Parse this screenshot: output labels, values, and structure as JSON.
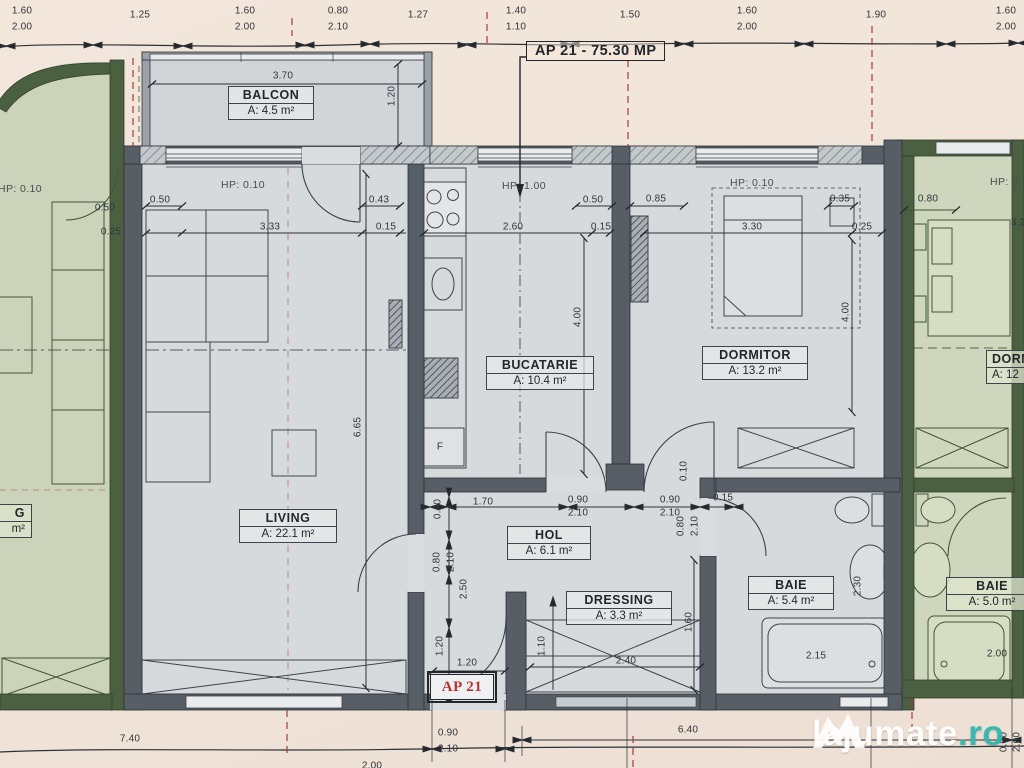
{
  "title": "AP 21 - 75.30 MP",
  "apartment_tag": "AP 21",
  "watermark": {
    "brand": "lajumate",
    "tld": ".ro"
  },
  "rooms": {
    "balcon": {
      "name": "BALCON",
      "area": "A: 4.5 m²"
    },
    "bucatarie": {
      "name": "BUCATARIE",
      "area": "A: 10.4 m²"
    },
    "dormitor": {
      "name": "DORMITOR",
      "area": "A: 13.2 m²"
    },
    "living": {
      "name": "LIVING",
      "area": "A: 22.1 m²"
    },
    "hol": {
      "name": "HOL",
      "area": "A: 6.1 m²"
    },
    "dressing": {
      "name": "DRESSING",
      "area": "A: 3.3 m²"
    },
    "baie": {
      "name": "BAIE",
      "area": "A: 5.4 m²"
    }
  },
  "adjacent": {
    "right_dormitor": {
      "name": "DORM",
      "area": "A: 12"
    },
    "right_baie": {
      "name": "BAIE",
      "area": "A: 5.0 m²"
    },
    "left_room": {
      "name": "G",
      "area": "m²"
    }
  },
  "colors": {
    "accent_red": "#a93b33",
    "watermark_teal": "#31b5ac",
    "wall_gray": "#575e66",
    "wall_green": "#4a6040",
    "floor_gray": "#d7dadc",
    "floor_green": "#cbd4ba",
    "paper": "#f1e5da"
  },
  "dims": [
    {
      "t": "1.60",
      "x": 22,
      "y": 11
    },
    {
      "t": "2.00",
      "x": 22,
      "y": 27
    },
    {
      "t": "1.25",
      "x": 140,
      "y": 15
    },
    {
      "t": "1.60",
      "x": 245,
      "y": 11
    },
    {
      "t": "2.00",
      "x": 245,
      "y": 27
    },
    {
      "t": "0.80",
      "x": 338,
      "y": 11
    },
    {
      "t": "2.10",
      "x": 338,
      "y": 27
    },
    {
      "t": "1.27",
      "x": 418,
      "y": 15
    },
    {
      "t": "1.40",
      "x": 516,
      "y": 11
    },
    {
      "t": "1.10",
      "x": 516,
      "y": 27
    },
    {
      "t": "1.50",
      "x": 630,
      "y": 15
    },
    {
      "t": "1.60",
      "x": 747,
      "y": 11
    },
    {
      "t": "2.00",
      "x": 747,
      "y": 27
    },
    {
      "t": "1.90",
      "x": 876,
      "y": 15
    },
    {
      "t": "1.60",
      "x": 1006,
      "y": 11
    },
    {
      "t": "2.00",
      "x": 1006,
      "y": 27
    },
    {
      "t": "3.70",
      "x": 283,
      "y": 76
    },
    {
      "t": "1.20",
      "x": 392,
      "y": 96,
      "r": 1
    },
    {
      "t": "HP: 0.10",
      "x": 243,
      "y": 185,
      "hp": 1
    },
    {
      "t": "HP: 1.00",
      "x": 524,
      "y": 186,
      "hp": 1
    },
    {
      "t": "HP: 0.10",
      "x": 752,
      "y": 183,
      "hp": 1
    },
    {
      "t": "HP: 0.10",
      "x": 20,
      "y": 189,
      "hp": 1
    },
    {
      "t": "HP: 0.10",
      "x": 1012,
      "y": 182,
      "hp": 1
    },
    {
      "t": "0.50",
      "x": 105,
      "y": 208
    },
    {
      "t": "0.25",
      "x": 111,
      "y": 232
    },
    {
      "t": "0.50",
      "x": 160,
      "y": 200
    },
    {
      "t": "3.33",
      "x": 270,
      "y": 227
    },
    {
      "t": "0.43",
      "x": 379,
      "y": 200
    },
    {
      "t": "0.15",
      "x": 386,
      "y": 227
    },
    {
      "t": "2.60",
      "x": 513,
      "y": 227
    },
    {
      "t": "0.15",
      "x": 601,
      "y": 227
    },
    {
      "t": "0.50",
      "x": 593,
      "y": 200
    },
    {
      "t": "0.85",
      "x": 656,
      "y": 199
    },
    {
      "t": "3.30",
      "x": 752,
      "y": 227
    },
    {
      "t": "0.25",
      "x": 862,
      "y": 227
    },
    {
      "t": "0.35",
      "x": 840,
      "y": 199
    },
    {
      "t": "0.80",
      "x": 928,
      "y": 199
    },
    {
      "t": "3.2",
      "x": 1018,
      "y": 223
    },
    {
      "t": "4.00",
      "x": 578,
      "y": 317,
      "r": 1
    },
    {
      "t": "6.65",
      "x": 358,
      "y": 427,
      "r": 1
    },
    {
      "t": "4.00",
      "x": 846,
      "y": 312,
      "r": 1
    },
    {
      "t": "0.40",
      "x": 438,
      "y": 509,
      "r": 1
    },
    {
      "t": "1.70",
      "x": 483,
      "y": 502
    },
    {
      "t": "0.90",
      "x": 578,
      "y": 500
    },
    {
      "t": "2.10",
      "x": 578,
      "y": 513
    },
    {
      "t": "0.90",
      "x": 670,
      "y": 500
    },
    {
      "t": "2.10",
      "x": 670,
      "y": 513
    },
    {
      "t": "0.15",
      "x": 723,
      "y": 498
    },
    {
      "t": "0.10",
      "x": 684,
      "y": 471,
      "r": 1
    },
    {
      "t": "0.80",
      "x": 681,
      "y": 526,
      "r": 1
    },
    {
      "t": "2.10",
      "x": 695,
      "y": 526,
      "r": 1
    },
    {
      "t": "0.80",
      "x": 437,
      "y": 562,
      "r": 1
    },
    {
      "t": "2.10",
      "x": 451,
      "y": 562,
      "r": 1
    },
    {
      "t": "2.50",
      "x": 464,
      "y": 589,
      "r": 1
    },
    {
      "t": "1.20",
      "x": 440,
      "y": 646,
      "r": 1
    },
    {
      "t": "1.20",
      "x": 467,
      "y": 663
    },
    {
      "t": "1.10",
      "x": 542,
      "y": 646,
      "r": 1
    },
    {
      "t": "2.40",
      "x": 626,
      "y": 661
    },
    {
      "t": "1.60",
      "x": 689,
      "y": 622,
      "r": 1
    },
    {
      "t": "2.15",
      "x": 816,
      "y": 656
    },
    {
      "t": "2.30",
      "x": 858,
      "y": 586,
      "r": 1
    },
    {
      "t": "2.00",
      "x": 997,
      "y": 654
    },
    {
      "t": "F",
      "x": 440,
      "y": 447
    },
    {
      "t": "7.40",
      "x": 130,
      "y": 739
    },
    {
      "t": "2.00",
      "x": 372,
      "y": 766
    },
    {
      "t": "0.90",
      "x": 448,
      "y": 733
    },
    {
      "t": "2.10",
      "x": 448,
      "y": 749
    },
    {
      "t": "6.40",
      "x": 688,
      "y": 730
    },
    {
      "t": "0.90",
      "x": 1004,
      "y": 742,
      "r": 1
    },
    {
      "t": "2.00",
      "x": 1017,
      "y": 742,
      "r": 1
    }
  ]
}
